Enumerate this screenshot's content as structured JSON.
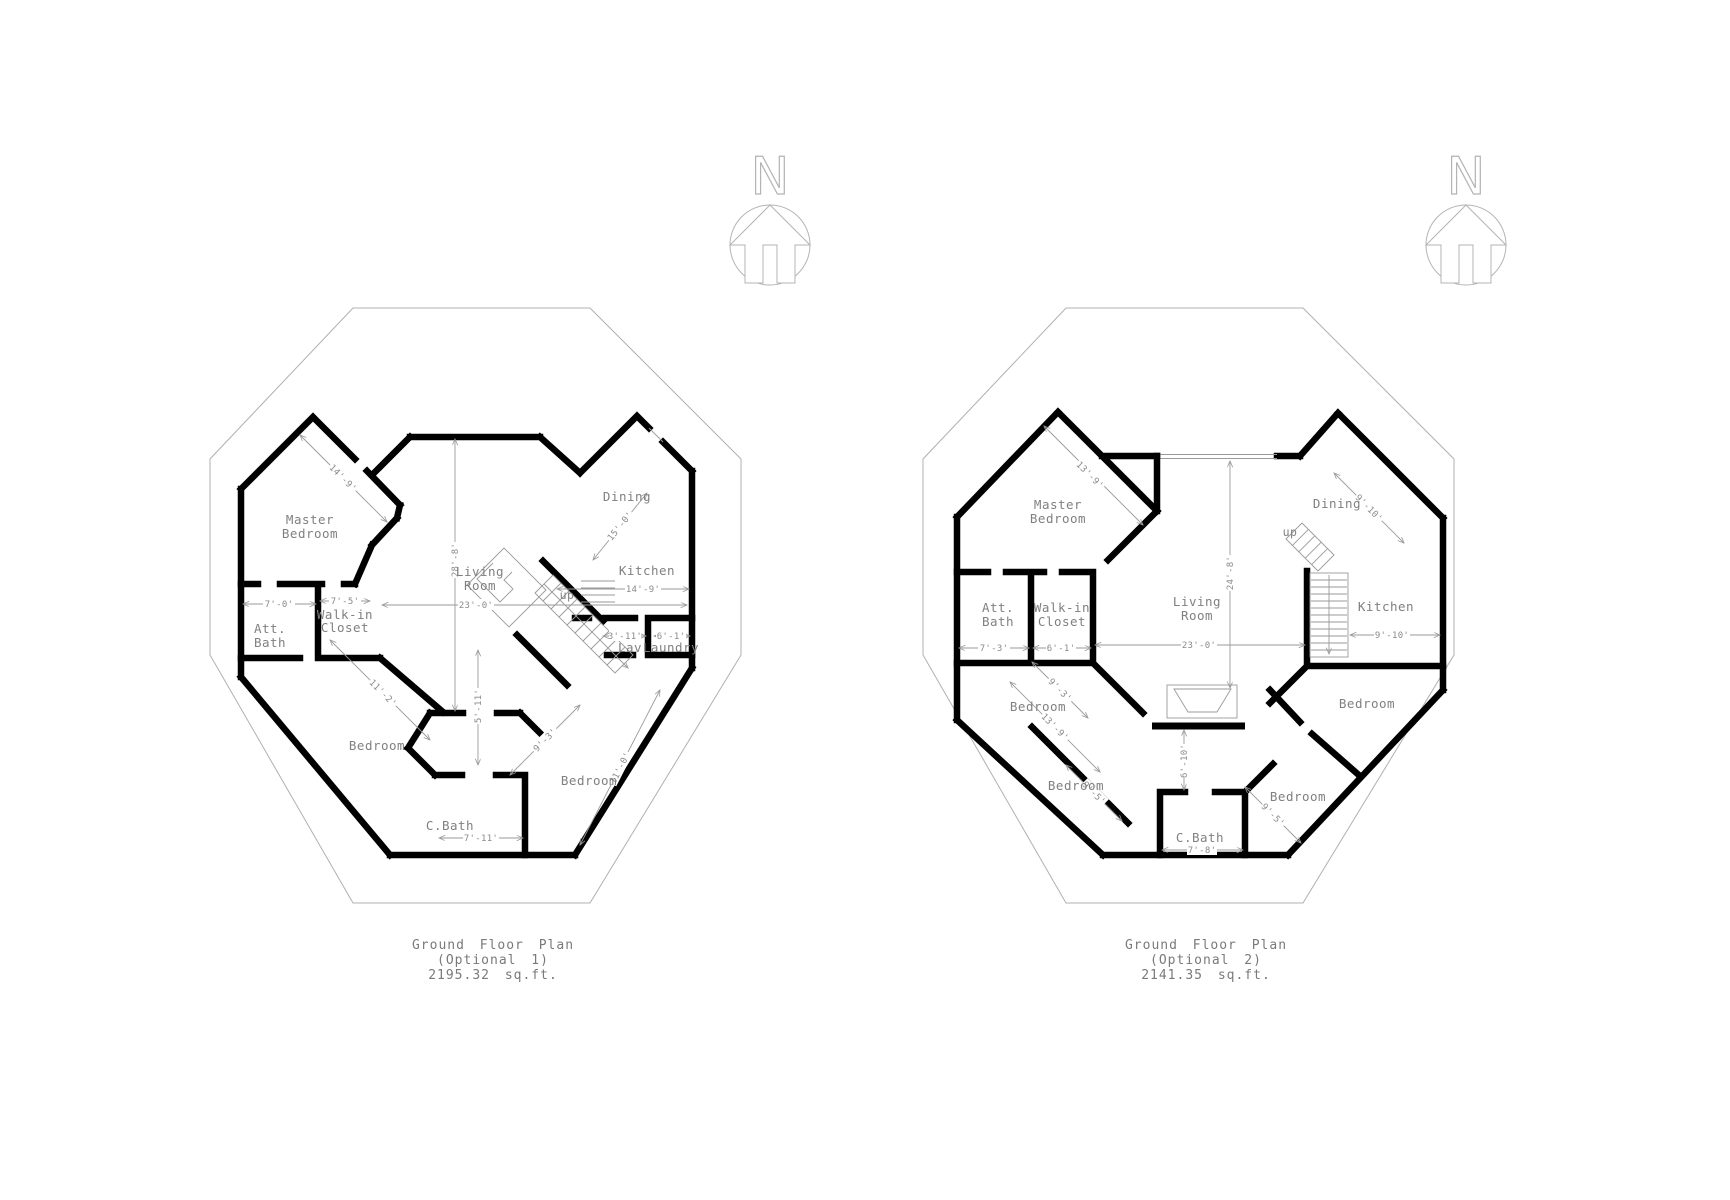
{
  "page": {
    "background": "#ffffff"
  },
  "colors": {
    "wall": "#000000",
    "thin_line": "#b0b0b0",
    "dim_line": "#9a9a9a",
    "label_text": "#808080",
    "caption_text": "#7a7a7a"
  },
  "compass": {
    "letter": "N"
  },
  "plans": [
    {
      "caption": {
        "l1": "Ground Floor Plan",
        "l2": "(Optional 1)",
        "l3": "2195.32 sq.ft."
      },
      "rooms": {
        "master": {
          "l1": "Master",
          "l2": "Bedroom",
          "dim": "14'-9'"
        },
        "dining": {
          "l": "Dining",
          "dim": "15'-0'"
        },
        "living": {
          "l1": "Living",
          "l2": "Room",
          "dim_v": "28'-8'",
          "dim_h": "23'-0'"
        },
        "kitchen": {
          "l": "Kitchen",
          "dim": "14'-9'"
        },
        "stairs": {
          "l": "up"
        },
        "att_bath": {
          "l1": "Att.",
          "l2": "Bath",
          "dim": "7'-0'"
        },
        "closet": {
          "l1": "Walk-in",
          "l2": "Closet",
          "dim": "7'-5'"
        },
        "lav": {
          "l": "Lav",
          "dim": "3'-11'"
        },
        "laundry": {
          "l": "Laundry",
          "dim": "6'-1'"
        },
        "bedroom_sw": {
          "l": "Bedroom",
          "dim": "11'-2'"
        },
        "bedroom_se": {
          "l": "Bedroom",
          "dim_a": "9'-3'",
          "dim_b": "11'-0'"
        },
        "cbath": {
          "l": "C.Bath",
          "dim_v": "5'-11'",
          "dim_h": "7'-11'"
        }
      }
    },
    {
      "caption": {
        "l1": "Ground Floor Plan",
        "l2": "(Optional 2)",
        "l3": "2141.35 sq.ft."
      },
      "rooms": {
        "master": {
          "l1": "Master",
          "l2": "Bedroom",
          "dim": "13'-9'"
        },
        "dining": {
          "l": "Dining",
          "dim": "9'-10'"
        },
        "living": {
          "l1": "Living",
          "l2": "Room",
          "dim_v": "24'-8'",
          "dim_h": "23'-0'"
        },
        "kitchen": {
          "l": "Kitchen",
          "dim": "9'-10'"
        },
        "stairs": {
          "l": "up"
        },
        "att_bath": {
          "l1": "Att.",
          "l2": "Bath",
          "dim": "7'-3'"
        },
        "closet": {
          "l1": "Walk-in",
          "l2": "Closet",
          "dim": "6'-1'"
        },
        "bedroom_w": {
          "l": "Bedroom",
          "dim_a": "9'-3'",
          "dim_b": "13'-9'"
        },
        "bedroom_sw": {
          "l": "Bedroom",
          "dim": "9'-5'"
        },
        "bedroom_s": {
          "l": "Bedroom",
          "dim": "9'-5'"
        },
        "bedroom_e": {
          "l": "Bedroom"
        },
        "cbath": {
          "l": "C.Bath",
          "dim": "7'-8'"
        },
        "fireplace": {
          "dim": "6'-10'"
        }
      }
    }
  ]
}
